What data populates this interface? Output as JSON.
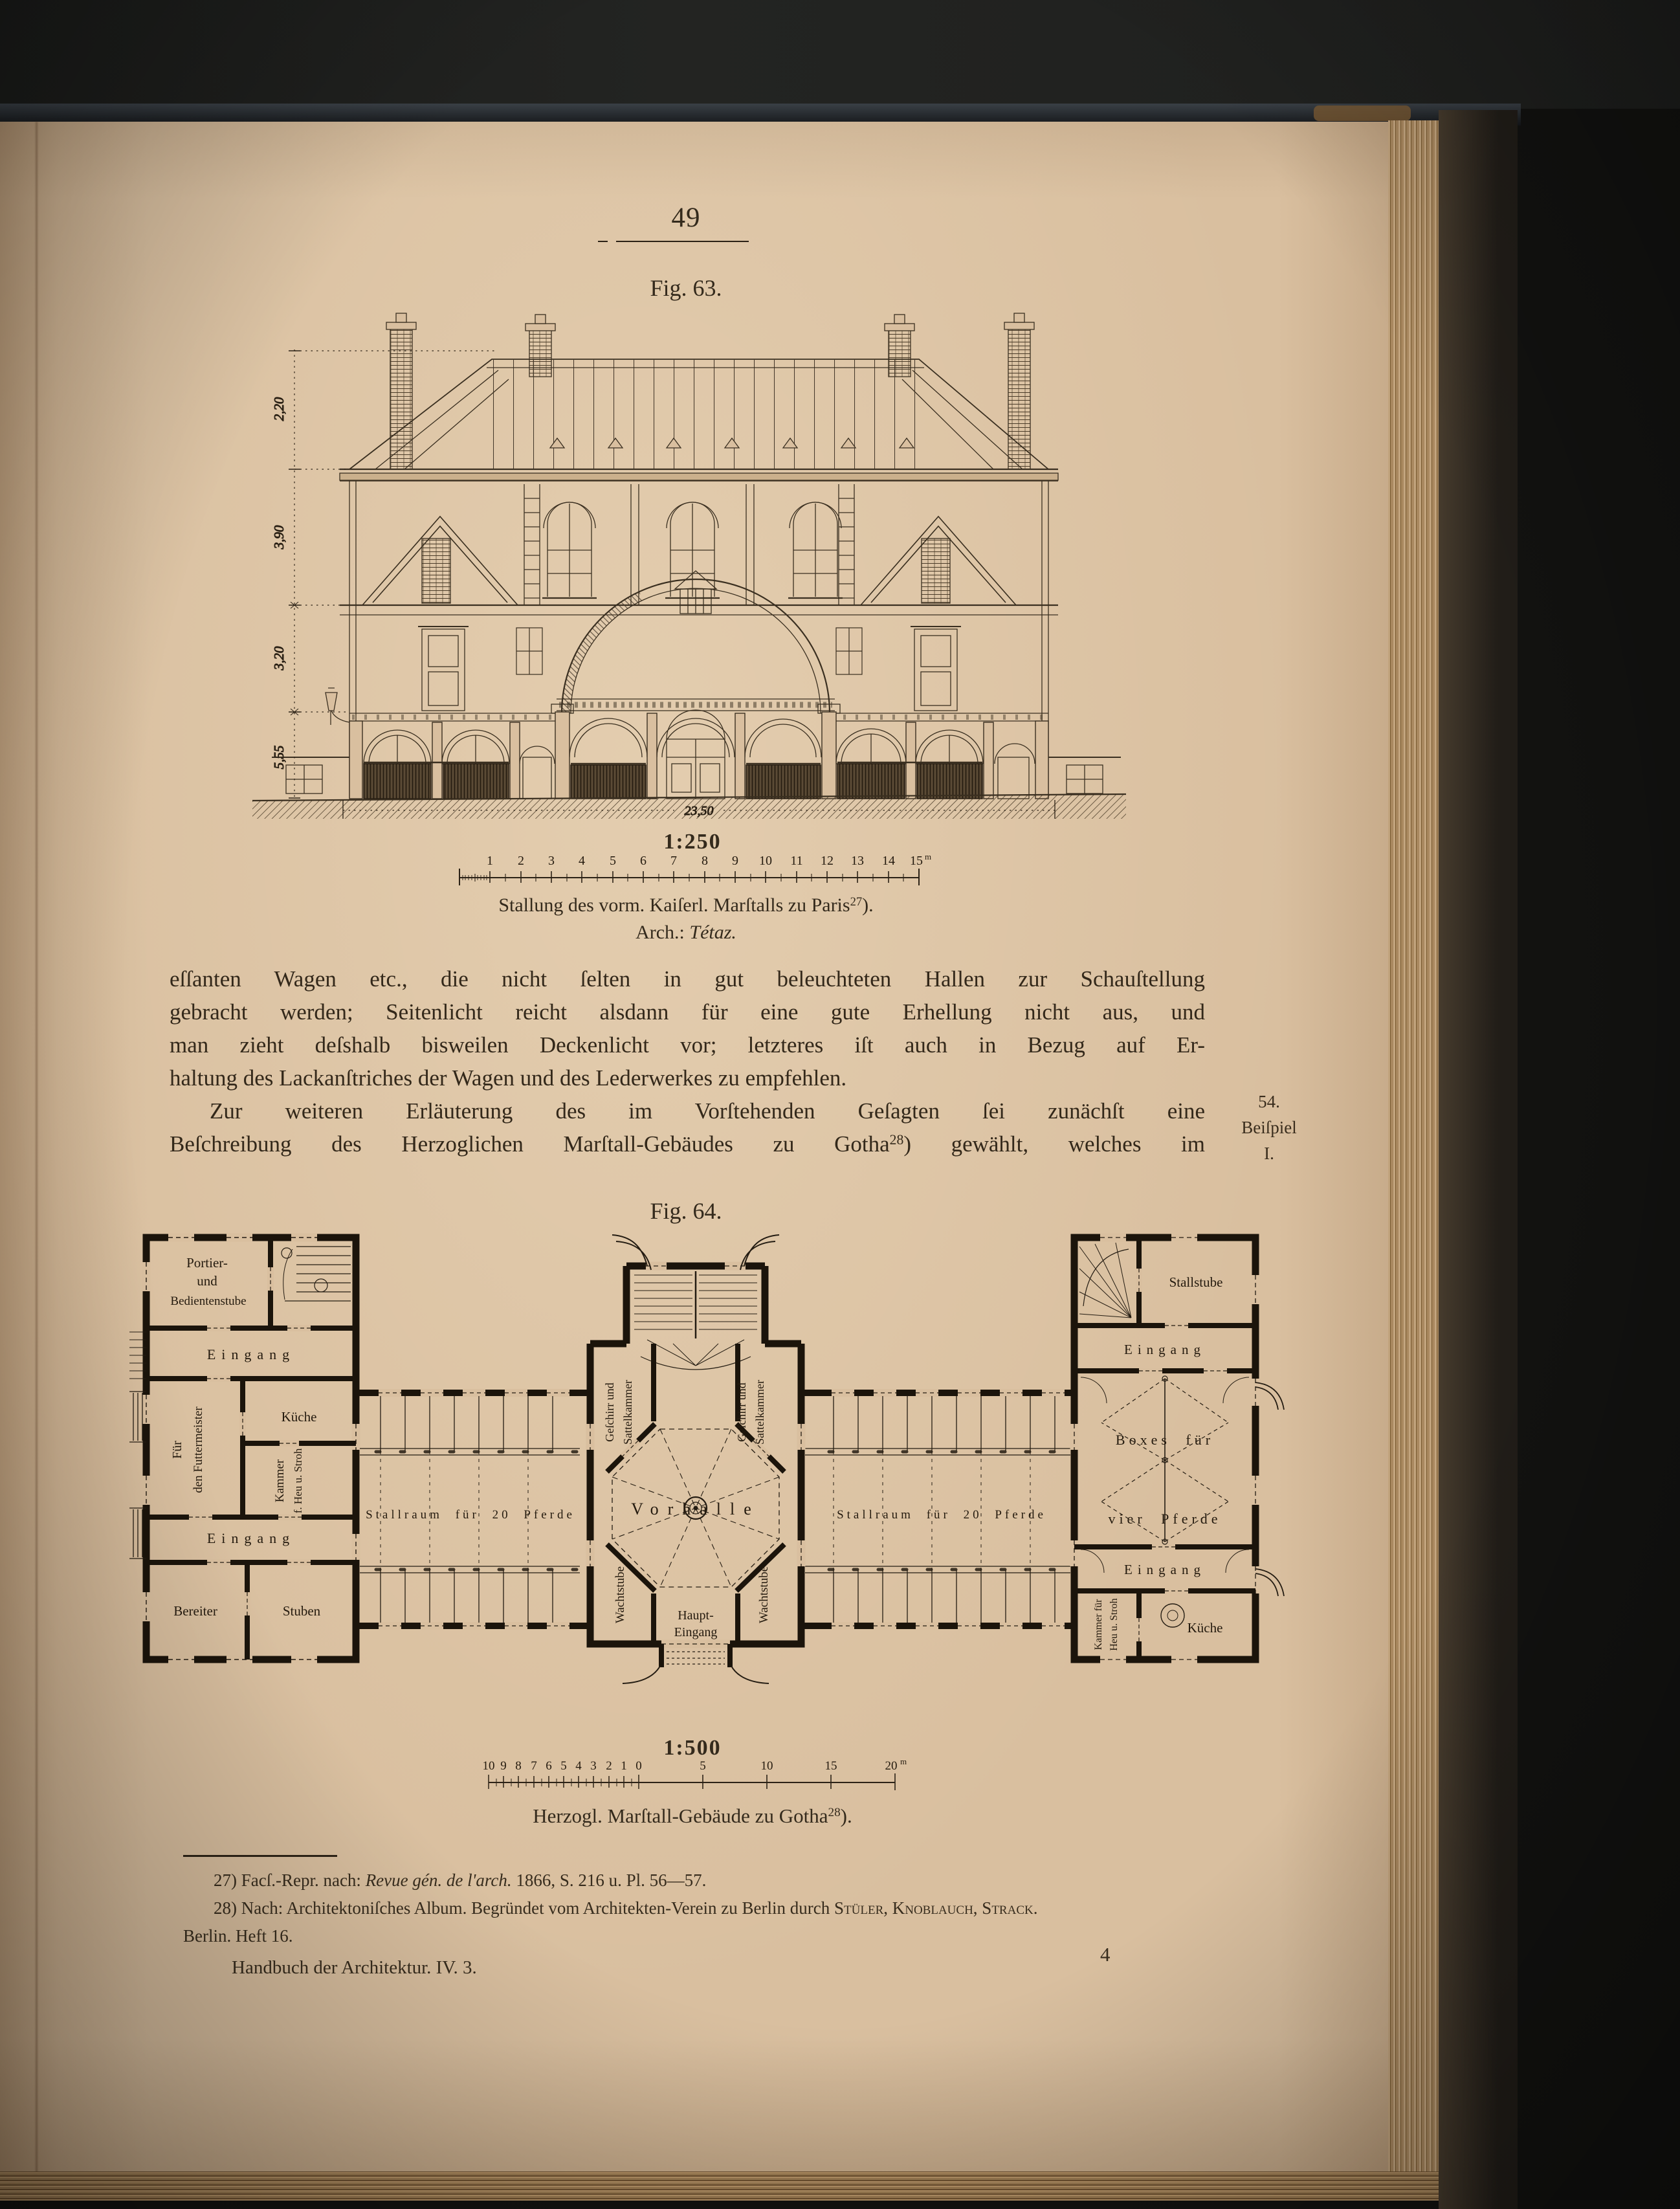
{
  "colors": {
    "paper": "#d9bf9f",
    "ink": "#2c2216",
    "drawing_ink": "#3a2f20",
    "background": "#121210"
  },
  "header": {
    "page_number": "49"
  },
  "fig63": {
    "label": "Fig. 63.",
    "scale": "1:250",
    "ruler_labels": [
      "1",
      "2",
      "3",
      "4",
      "5",
      "6",
      "7",
      "8",
      "9",
      "10",
      "11",
      "12",
      "13",
      "14",
      "15"
    ],
    "ruler_unit": "m",
    "dim_roof": "2,20",
    "dim_upper": "3,90",
    "dim_middle": "3,20",
    "dim_ground": "5,55",
    "dim_width": "23,50",
    "caption": "Stallung des vorm. Kaiſerl. Marſtalls zu Paris",
    "caption_sup": "27",
    "caption_end": ").",
    "arch_label": "Arch.: ",
    "arch_name": "Tétaz."
  },
  "paragraph": {
    "l1": "eſſanten Wagen etc., die nicht ſelten in gut beleuchteten Hallen zur Schauſtellung",
    "l2": "gebracht werden; Seitenlicht reicht alsdann für eine gute Erhellung nicht aus, und",
    "l3": "man zieht deſshalb bisweilen Deckenlicht vor; letzteres iſt auch in Bezug auf Er-",
    "l4": "haltung des Lackanſtriches der Wagen und des Lederwerkes zu empfehlen.",
    "l5": "Zur weiteren Erläuterung des im Vorſtehenden Geſagten ſei zunächſt eine",
    "l6a": "Beſchreibung des Herzoglichen Marſtall-Gebäudes zu Gotha",
    "l6sup": "28",
    "l6b": ") gewählt, welches im"
  },
  "margin_note": {
    "number": "54.",
    "word": "Beiſpiel",
    "roman": "I."
  },
  "fig64": {
    "label": "Fig. 64.",
    "scale": "1:500",
    "ruler_left": [
      "10",
      "9",
      "8",
      "7",
      "6",
      "5",
      "4",
      "3",
      "2",
      "1",
      "0"
    ],
    "ruler_right": [
      "5",
      "10",
      "15",
      "20"
    ],
    "ruler_unit": "m",
    "caption": "Herzogl. Marſtall-Gebäude zu Gotha",
    "caption_sup": "28",
    "caption_end": ").",
    "rooms": {
      "portier1": "Portier-",
      "portier2": "und",
      "portier3": "Bedientenstube",
      "eingang": "Eingang",
      "kueche": "Küche",
      "fuer": "Für",
      "futtermeister": "den Futtermeister",
      "kammer": "Kammer",
      "heu": "f. Heu u. Stroh",
      "bereiter": "Bereiter",
      "stuben": "Stuben",
      "stallraum": "Stallraum für 20 Pferde",
      "geschirr": "Geſchirr und",
      "sattel": "Sattelkammer",
      "vorhalle": "Vorhalle",
      "wacht": "Wachtstube",
      "haupt1": "Haupt-",
      "haupt2": "Eingang",
      "stallstube": "Stallstube",
      "boxes1": "Boxes für",
      "boxes2": "vier Pferde",
      "kammer2a": "Kammer für",
      "kammer2b": "Heu u. Stroh"
    }
  },
  "footnotes": {
    "fn27_a": "27) Facſ.-Repr. nach: ",
    "fn27_title": "Revue gén. de l'arch.",
    "fn27_b": " 1866, S. 216 u. Pl. 56—57.",
    "fn28_a": "28) Nach: Architektoniſches Album.  Begründet vom Architekten-Verein zu Berlin durch ",
    "fn28_names": "Stüler, Knoblauch, Strack",
    "fn28_b": ".",
    "fn28_cont": "Berlin.  Heft 16."
  },
  "footer": {
    "imprint": "Handbuch der Architektur.  IV. 3.",
    "signature": "4"
  }
}
